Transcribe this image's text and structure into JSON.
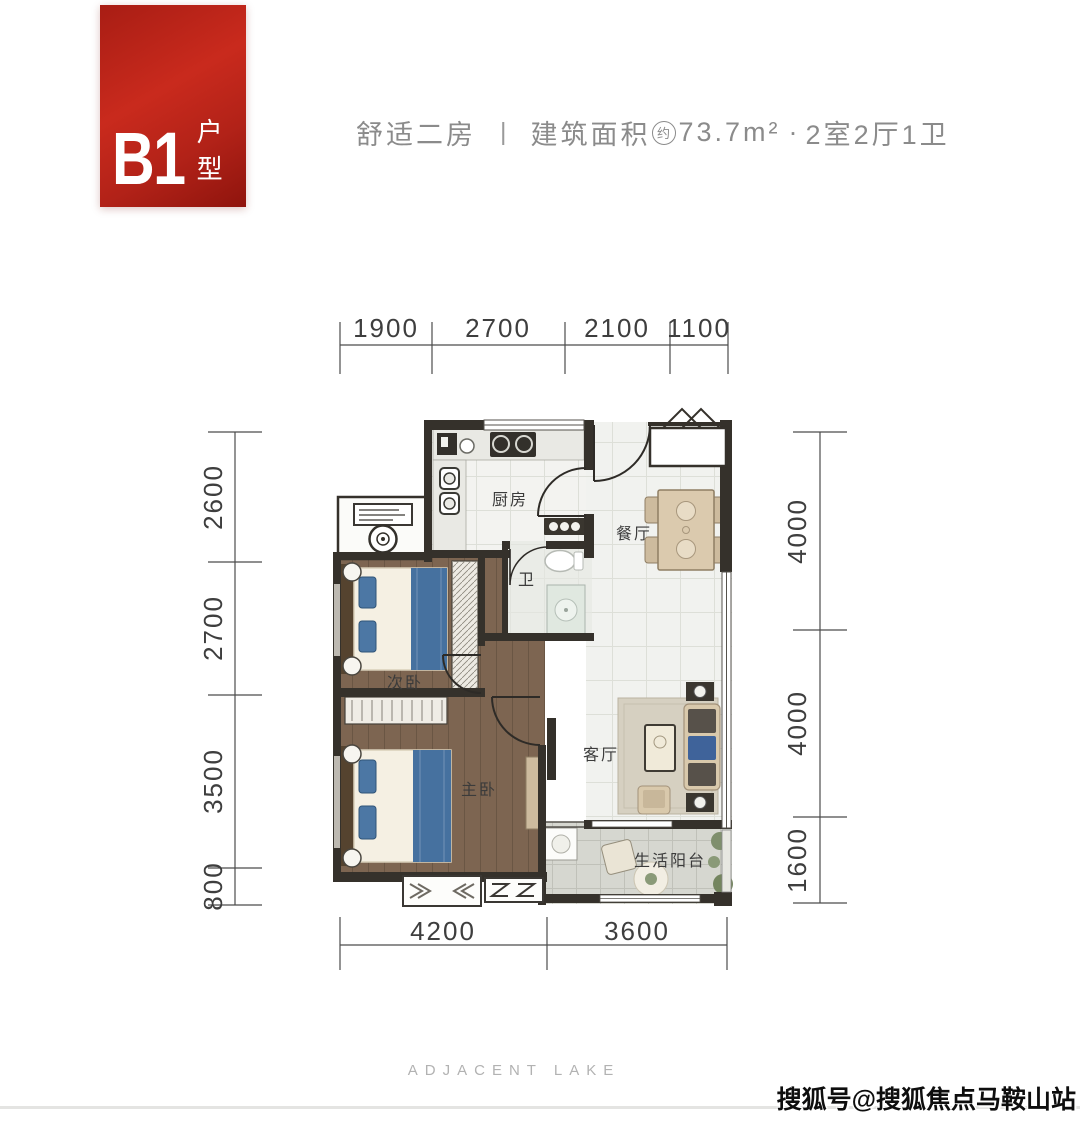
{
  "badge": {
    "code": "B1",
    "suffix": "户型"
  },
  "header": {
    "type_name": "舒适二房",
    "divider": "|",
    "area_label": "建筑面积",
    "approx_mark": "约",
    "area_value": "73.7m²",
    "dot": "·",
    "layout": "2室2厅1卫"
  },
  "rooms": {
    "kitchen": "厨房",
    "dining": "餐厅",
    "bath": "卫",
    "second_bedroom": "次卧",
    "master_bedroom": "主卧",
    "living": "客厅",
    "balcony": "生活阳台"
  },
  "dimensions": {
    "top": [
      "1900",
      "2700",
      "2100",
      "1100"
    ],
    "left": [
      "2600",
      "2700",
      "3500",
      "800"
    ],
    "right": [
      "4000",
      "4000",
      "1600"
    ],
    "bottom": [
      "4200",
      "3600"
    ]
  },
  "footer": {
    "brand": "ADJACENT LAKE"
  },
  "watermark": {
    "text": "搜狐号@搜狐焦点马鞍山站"
  },
  "colors": {
    "accent_red": "#b9231a",
    "wall": "#35312b",
    "wood_floor": "#7d6551",
    "bed_blue": "#46719f",
    "tile": "#f1f2ef"
  }
}
